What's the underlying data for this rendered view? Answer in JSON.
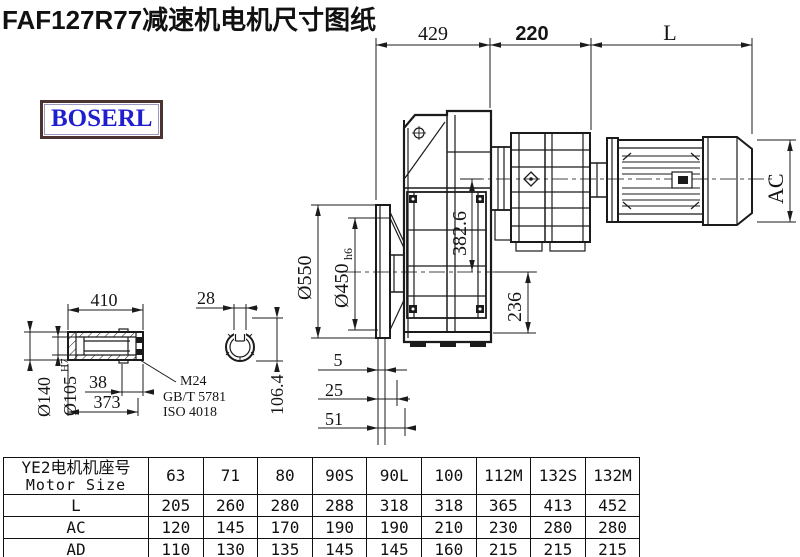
{
  "title": "FAF127R77减速机电机尺寸图纸",
  "logo": "BOSERL",
  "colors": {
    "line": "#1b1b1b",
    "logo_text": "#1f1fd0",
    "logo_border": "#4b3430"
  },
  "drawing": {
    "dims": {
      "top_left": "429",
      "top_mid": "220",
      "top_right": "L",
      "ac": "AC",
      "flange_od": "Ø550",
      "spigot": "Ø450",
      "spigot_tol": "h6",
      "axis_offset": "382.6",
      "foot": "236",
      "shaft_len": "410",
      "key_w": "28",
      "shaft_od": "Ø140",
      "bore": "Ø105",
      "bore_tol": "H7",
      "groove": "38",
      "hub_len": "373",
      "key_h": "106.4",
      "gap5": "5",
      "gap25": "25",
      "gap51": "51"
    },
    "notes": {
      "thread": "M24",
      "std1": "GB/T 5781",
      "std2": "ISO 4018"
    }
  },
  "table": {
    "header": {
      "label_line1": "YE2电机机座号",
      "label_line2": "Motor Size",
      "columns": [
        "63",
        "71",
        "80",
        "90S",
        "90L",
        "100",
        "112M",
        "132S",
        "132M"
      ]
    },
    "rows": [
      {
        "label": "L",
        "values": [
          "205",
          "260",
          "280",
          "288",
          "318",
          "318",
          "365",
          "413",
          "452"
        ]
      },
      {
        "label": "AC",
        "values": [
          "120",
          "145",
          "170",
          "190",
          "190",
          "210",
          "230",
          "280",
          "280"
        ]
      },
      {
        "label": "AD",
        "values": [
          "110",
          "130",
          "135",
          "145",
          "145",
          "160",
          "215",
          "215",
          "215"
        ]
      }
    ]
  }
}
